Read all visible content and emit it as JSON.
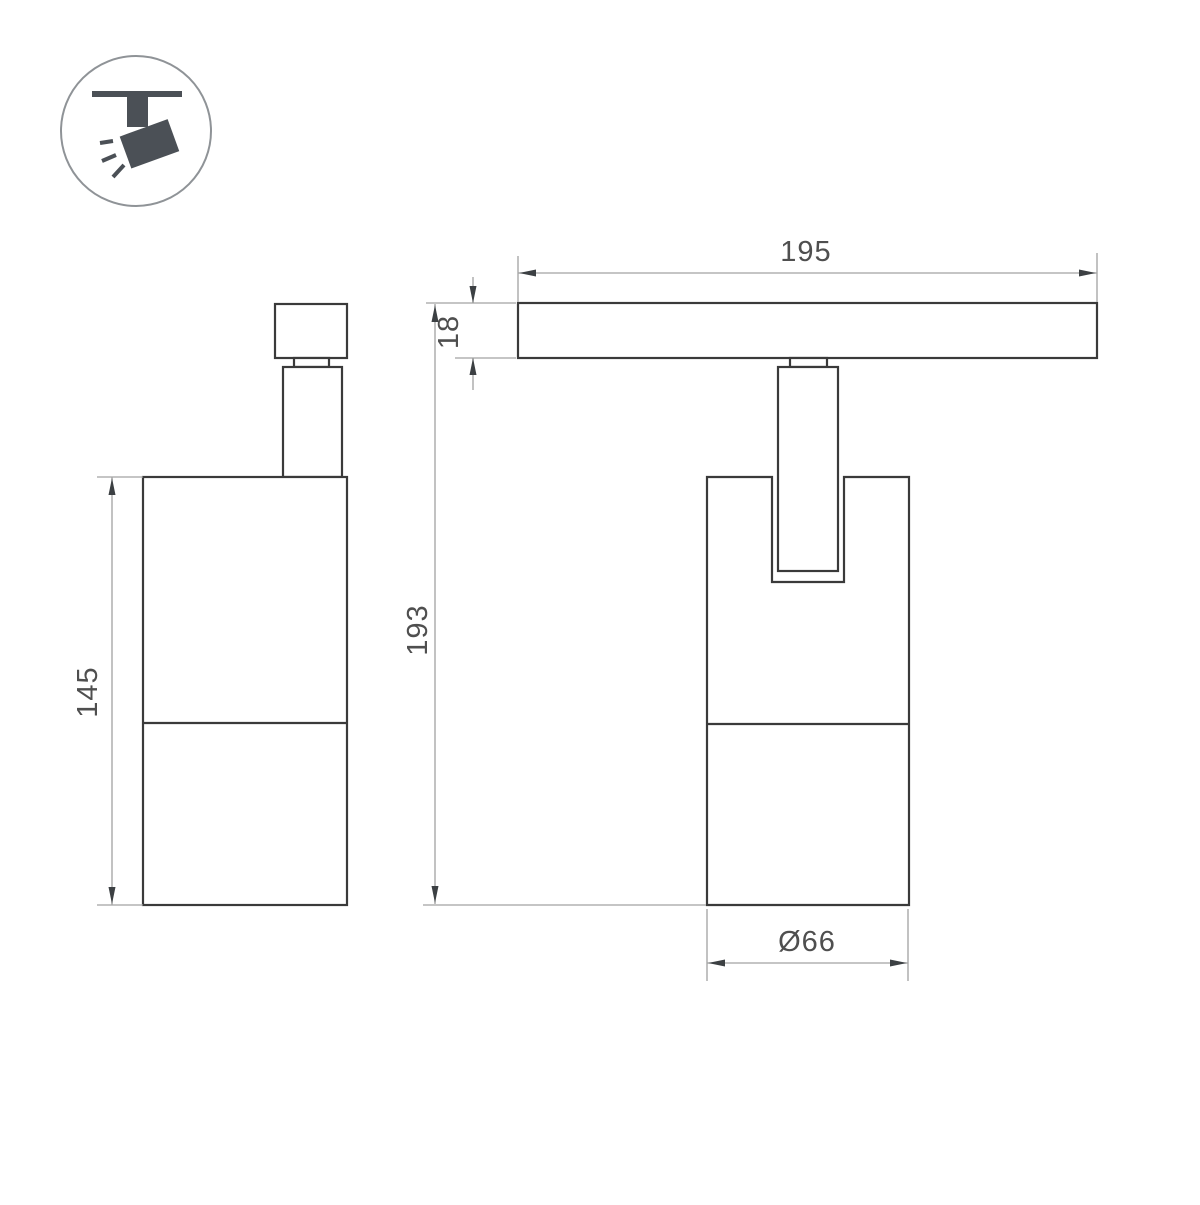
{
  "colors": {
    "background": "#ffffff",
    "outline": "#3a3a3a",
    "dimension_line": "#a2a2a2",
    "arrowhead": "#3c4043",
    "label_text": "#4f4f4f",
    "icon_fill": "#4b5056",
    "icon_circle_stroke": "#8f9397"
  },
  "icon": {
    "name": "track-spotlight-icon",
    "depicts": "ceiling track with tilted spotlight head and three light rays"
  },
  "drawing": {
    "views": [
      {
        "name": "side-view",
        "dimensions": [
          {
            "name": "body-height",
            "label": "145"
          }
        ]
      },
      {
        "name": "front-view",
        "dimensions": [
          {
            "name": "track-length",
            "label": "195"
          },
          {
            "name": "track-height",
            "label": "18"
          },
          {
            "name": "total-height",
            "label": "193"
          },
          {
            "name": "body-diameter",
            "label": "Ø66"
          }
        ]
      }
    ]
  }
}
